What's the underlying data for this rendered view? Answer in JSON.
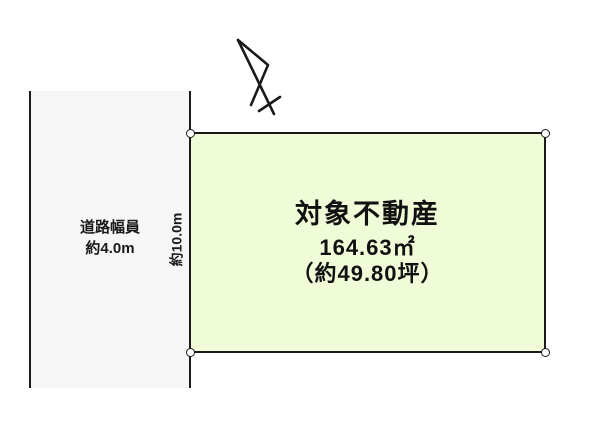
{
  "road": {
    "label_line1": "道路幅員",
    "label_line2": "約4.0m"
  },
  "frontage": {
    "label": "約10.0m"
  },
  "property": {
    "title": "対象不動産",
    "area_sqm": "164.63㎡",
    "area_tsubo": "（約49.80坪）"
  },
  "icons": {
    "north_arrow": "north-arrow",
    "corner_marker": "boundary-point-circle"
  },
  "colors": {
    "property_fill": "#f0fbd8",
    "road_fill": "#f6f6f6",
    "line": "#1a1a1a"
  }
}
